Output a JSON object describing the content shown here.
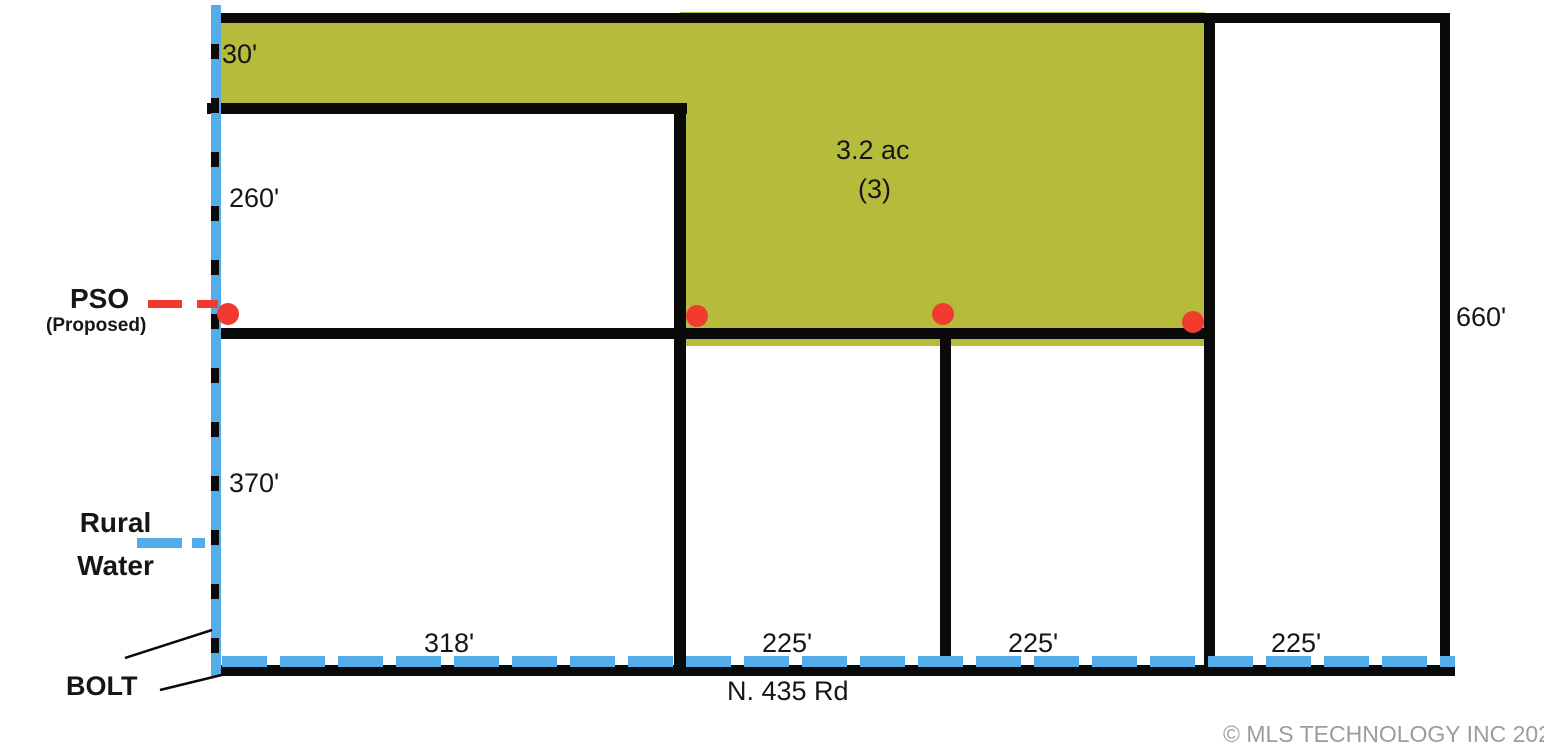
{
  "diagram": {
    "type": "plat-survey",
    "labels": {
      "top_depth": "30'",
      "left_upper_depth": "260'",
      "left_lower_depth": "370'",
      "right_depth": "660'",
      "bottom_widths": [
        "318'",
        "225'",
        "225'",
        "225'"
      ],
      "area": "3.2 ac",
      "lot_number": "(3)",
      "pso": "PSO",
      "pso_sub": "(Proposed)",
      "rural_water_line1": "Rural",
      "rural_water_line2": "Water",
      "bolt": "BOLT",
      "road": "N. 435 Rd"
    },
    "colors": {
      "highlight_green": "#b6bb3c",
      "water_blue": "#54ade9",
      "pso_red": "#f23b2e",
      "boundary_black": "#0a0a0a",
      "copyright_gray": "#9c9c9c"
    },
    "copyright": "© MLS TECHNOLOGY INC 2025"
  }
}
